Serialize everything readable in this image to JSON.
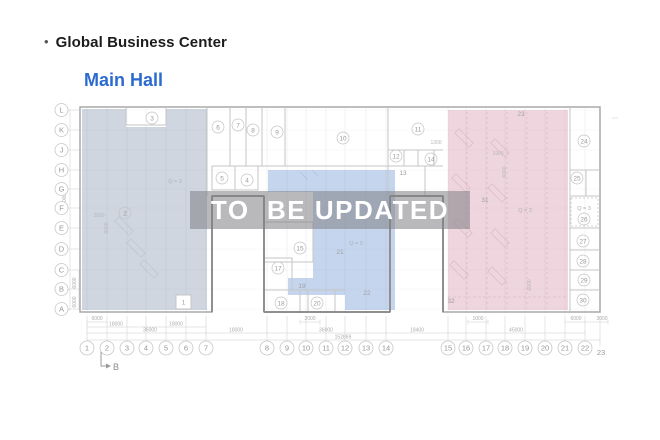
{
  "header": {
    "bullet": "•",
    "title": "Global Business Center",
    "subtitle": "Main Hall"
  },
  "watermark": {
    "text": "TO  BE UPDATED"
  },
  "colors": {
    "link_blue": "#2b6bcf",
    "zone_left": "#ccd4de",
    "zone_middle": "#c2d3ed",
    "zone_right": "#eed3db",
    "watermark_band": "rgba(127,128,133,0.55)"
  },
  "plan": {
    "row_labels": [
      "L",
      "K",
      "J",
      "H",
      "G",
      "F",
      "E",
      "D",
      "C",
      "B",
      "A"
    ],
    "col_labels": [
      "1",
      "2",
      "3",
      "4",
      "5",
      "6",
      "7",
      "8",
      "9",
      "10",
      "11",
      "12",
      "13",
      "14",
      "15",
      "16",
      "17",
      "18",
      "19",
      "20",
      "21",
      "22"
    ],
    "col_label_last": "23",
    "rooms_circled": [
      "2",
      "3",
      "4",
      "5",
      "6",
      "7",
      "8",
      "9",
      "10",
      "11",
      "12",
      "14",
      "15",
      "17",
      "18",
      "20",
      "24",
      "25",
      "26",
      "27",
      "28",
      "29",
      "30"
    ],
    "rooms_plain": [
      "1",
      "13",
      "19",
      "21",
      "22",
      "23",
      "31",
      "32"
    ],
    "zone_marks": [
      "Q = 3",
      "Q = 3",
      "Q = 3",
      "Q = 3"
    ],
    "dims_bottom": [
      "6000",
      "2000",
      "1000",
      "6000",
      "3000",
      "18000",
      "18000",
      "36000",
      "18000",
      "36000",
      "18400",
      "45000",
      "152869"
    ],
    "dims_left": [
      "60000",
      "6000",
      "6000"
    ],
    "dims_inner": [
      "1300",
      "1900",
      "2690",
      "9000",
      "6000",
      "6000"
    ],
    "section_marker": "B"
  }
}
